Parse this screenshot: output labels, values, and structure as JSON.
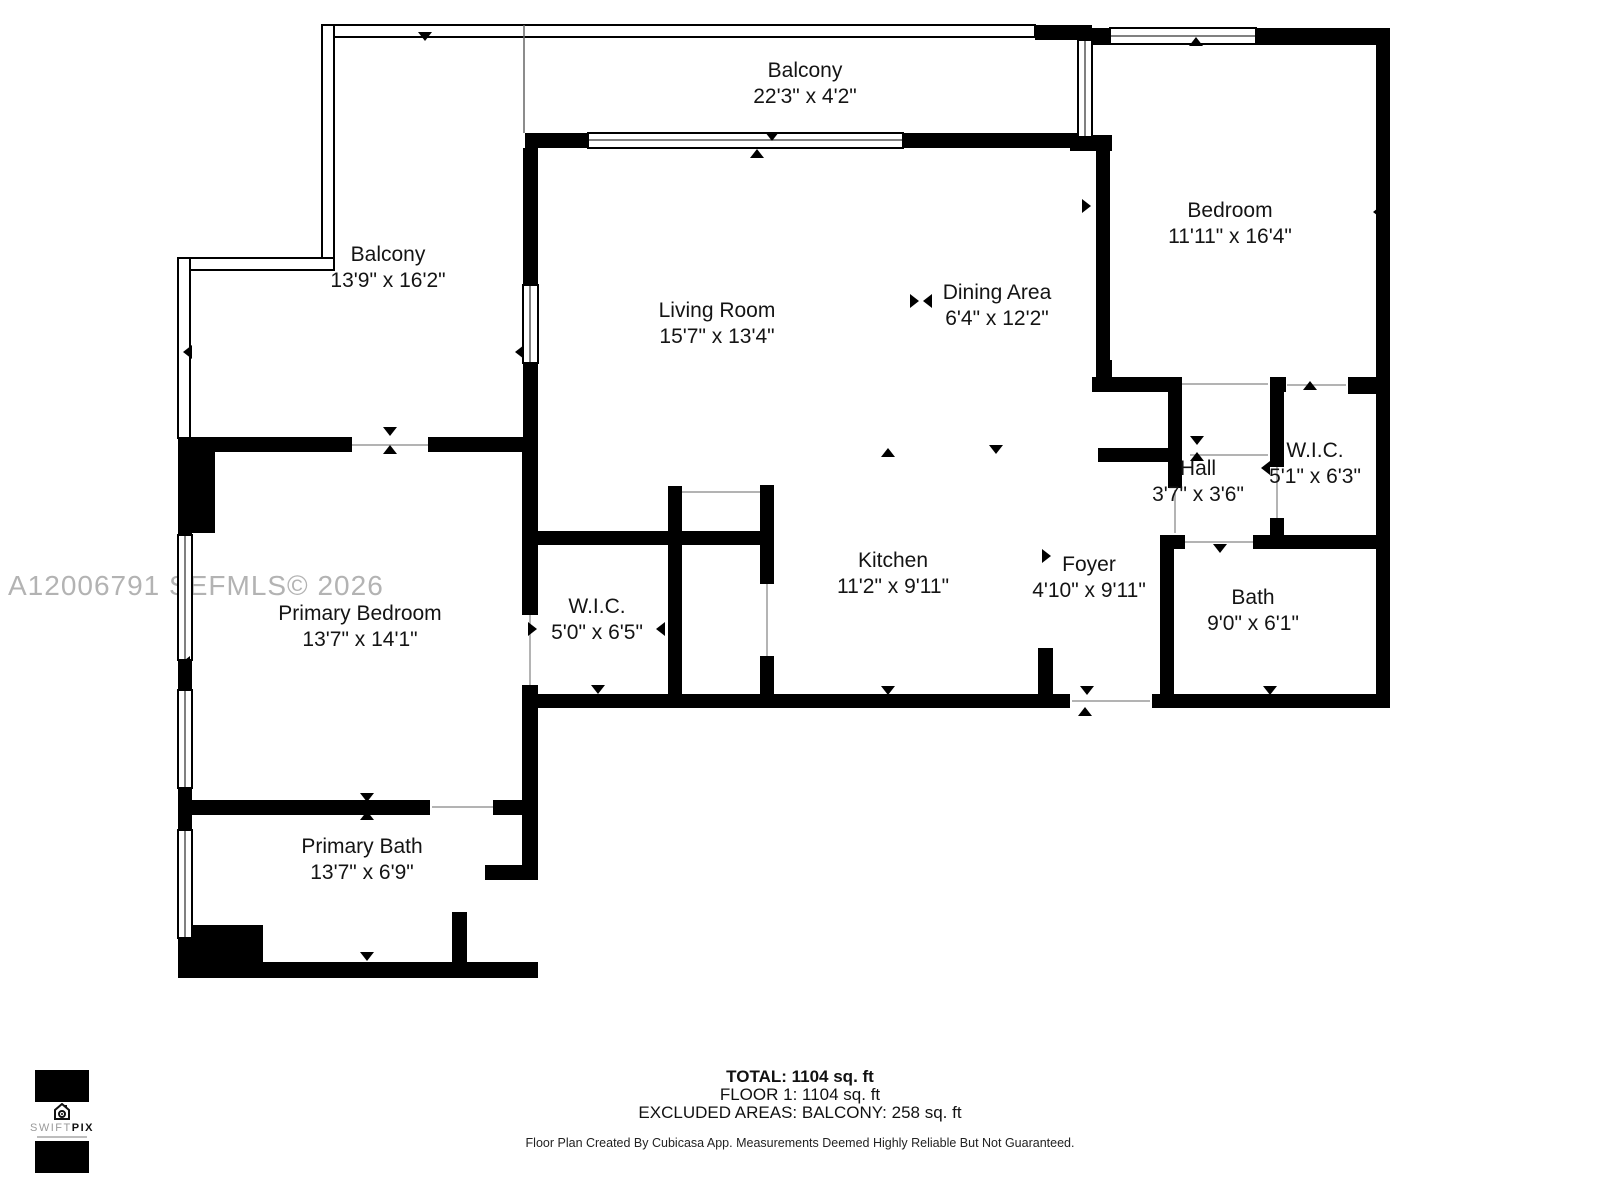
{
  "watermark": "A12006791  SEFMLS© 2026",
  "rooms": {
    "balcony_top": {
      "name": "Balcony",
      "dims": "22'3\" x 4'2\""
    },
    "balcony_left": {
      "name": "Balcony",
      "dims": "13'9\" x 16'2\""
    },
    "living_room": {
      "name": "Living Room",
      "dims": "15'7\" x 13'4\""
    },
    "dining_area": {
      "name": "Dining Area",
      "dims": "6'4\" x 12'2\""
    },
    "bedroom": {
      "name": "Bedroom",
      "dims": "11'11\" x 16'4\""
    },
    "hall": {
      "name": "Hall",
      "dims": "3'7\" x 3'6\""
    },
    "wic_right": {
      "name": "W.I.C.",
      "dims": "5'1\" x 6'3\""
    },
    "kitchen": {
      "name": "Kitchen",
      "dims": "11'2\" x 9'11\""
    },
    "foyer": {
      "name": "Foyer",
      "dims": "4'10\" x 9'11\""
    },
    "bath": {
      "name": "Bath",
      "dims": "9'0\" x 6'1\""
    },
    "primary_bedroom": {
      "name": "Primary Bedroom",
      "dims": "13'7\" x 14'1\""
    },
    "wic_left": {
      "name": "W.I.C.",
      "dims": "5'0\" x 6'5\""
    },
    "primary_bath": {
      "name": "Primary Bath",
      "dims": "13'7\" x 6'9\""
    }
  },
  "summary": {
    "total": "TOTAL: 1104 sq. ft",
    "floor": "FLOOR 1: 1104 sq. ft",
    "excluded": "EXCLUDED AREAS: BALCONY: 258 sq. ft",
    "disclaimer": "Floor Plan Created By Cubicasa App. Measurements Deemed Highly Reliable But Not Guaranteed."
  },
  "logo": {
    "brand_prefix": "SWIFT",
    "brand_suffix": "PIX"
  },
  "colors": {
    "wall": "#000000",
    "watermark": "#b3b3b3",
    "label_text": "#141414"
  }
}
